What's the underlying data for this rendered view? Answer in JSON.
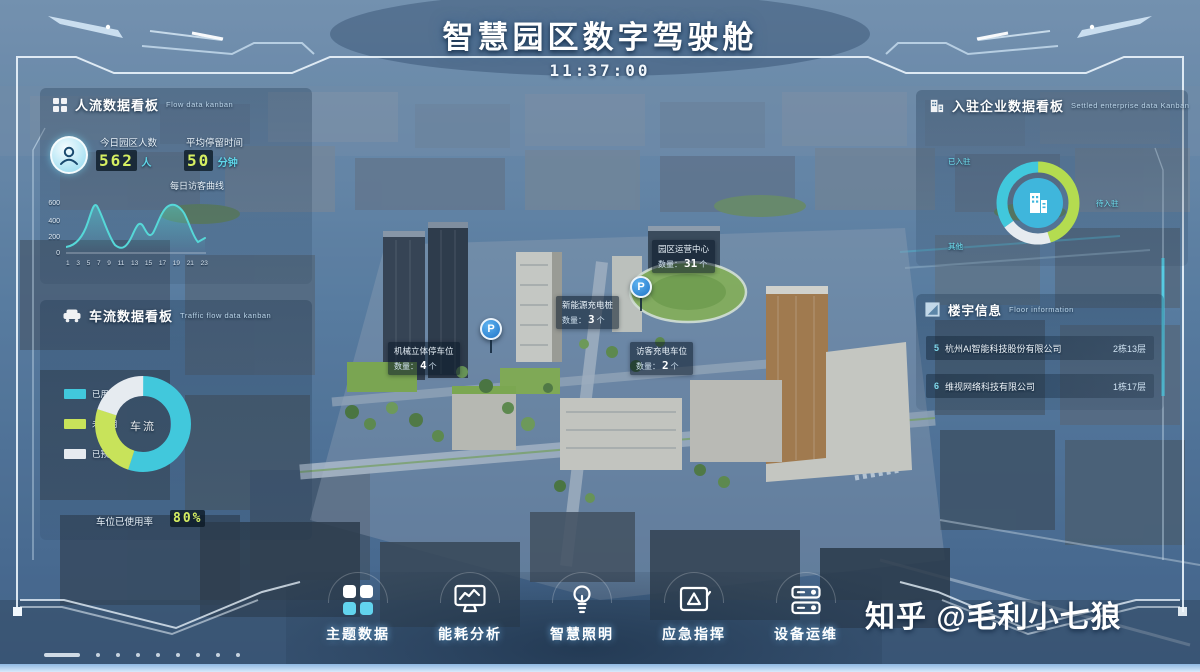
{
  "header": {
    "title": "智慧园区数字驾驶舱",
    "time": "11:37:00"
  },
  "flow_panel": {
    "title": "人流数据看板",
    "subtitle": "Flow data kanban",
    "stats": [
      {
        "label": "今日园区人数",
        "value": "562",
        "unit": "人"
      },
      {
        "label": "平均停留时间",
        "value": "50",
        "unit": "分钟"
      }
    ],
    "chart_title": "每日访客曲线",
    "y_ticks": [
      "600",
      "400",
      "200",
      "0"
    ],
    "x_ticks": [
      "1",
      "3",
      "5",
      "7",
      "9",
      "11",
      "13",
      "15",
      "17",
      "19",
      "21",
      "23"
    ]
  },
  "traffic_panel": {
    "title": "车流数据看板",
    "subtitle": "Traffic flow data kanban",
    "legend": [
      {
        "label": "已用",
        "color": "#41c8dc"
      },
      {
        "label": "未使用",
        "color": "#c8e35a"
      },
      {
        "label": "已预约",
        "color": "#e6ebf0"
      }
    ],
    "center_label": "车流",
    "usage_label": "车位已使用率",
    "usage_value": "80%"
  },
  "enterprise_panel": {
    "title": "入驻企业数据看板",
    "subtitle": "Settled enterprise data Kanban",
    "ring_labels": [
      "已入驻",
      "待入驻",
      "其他"
    ]
  },
  "building_panel": {
    "title": "楼宇信息",
    "subtitle": "Floor information",
    "rows": [
      {
        "index": "5",
        "name": "杭州AI智能科技股份有限公司",
        "loc": "2栋13层"
      },
      {
        "index": "6",
        "name": "维视网络科技有限公司",
        "loc": "1栋17层"
      }
    ]
  },
  "map_overlays": {
    "tooltips": [
      {
        "title": "机械立体停车位",
        "label": "数量：",
        "value": "4",
        "unit": "个"
      },
      {
        "title": "新能源充电桩",
        "label": "数量：",
        "value": "3",
        "unit": "个"
      },
      {
        "title": "访客充电车位",
        "label": "数量：",
        "value": "2",
        "unit": "个"
      },
      {
        "title": "园区运营中心",
        "label": "数量：",
        "value": "31",
        "unit": "个"
      }
    ],
    "markers": [
      {
        "glyph": "P"
      },
      {
        "glyph": "P"
      }
    ]
  },
  "nav": {
    "items": [
      {
        "label": "主题数据"
      },
      {
        "label": "能耗分析"
      },
      {
        "label": "智慧照明"
      },
      {
        "label": "应急指挥"
      },
      {
        "label": "设备运维"
      }
    ]
  },
  "watermark": "知乎 @毛利小七狼",
  "colors": {
    "accent_cyan": "#41c8dc",
    "accent_green": "#c8e35a",
    "pale_segment": "#e6ebf0",
    "marker_blue": "#2f8de0",
    "frame_line": "#e8f2fa"
  },
  "chart_data": [
    {
      "type": "line",
      "title": "每日访客曲线",
      "x": [
        1,
        3,
        5,
        7,
        9,
        11,
        13,
        15,
        17,
        19,
        21,
        23
      ],
      "values": [
        20,
        120,
        560,
        300,
        80,
        150,
        290,
        240,
        420,
        520,
        220,
        60
      ],
      "xlabel": "时",
      "ylabel": "人数",
      "ylim": [
        0,
        600
      ],
      "legend_position": "none",
      "grid": false
    },
    {
      "type": "pie",
      "title": "车流车位占比",
      "categories": [
        "已用",
        "未使用",
        "已预约"
      ],
      "values": [
        55,
        25,
        20
      ],
      "center_label": "车流",
      "annotation": "车位已使用率 80%"
    },
    {
      "type": "pie",
      "title": "入驻企业占比",
      "categories": [
        "已入驻",
        "待入驻",
        "其他"
      ],
      "values": [
        45,
        35,
        20
      ]
    }
  ]
}
